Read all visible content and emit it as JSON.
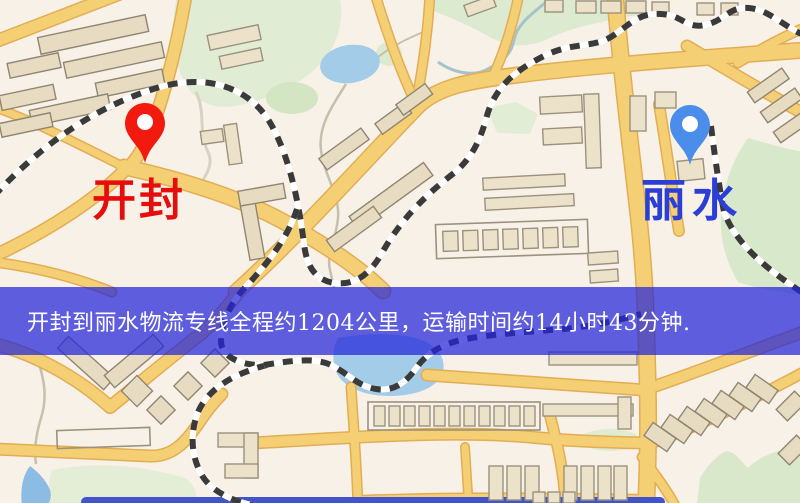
{
  "banner": {
    "text": "开封到丽水物流专线全程约1204公里，运输时间约14小时43分钟.",
    "bg_color": "#2224da",
    "opacity": "0.72",
    "text_color": "#ffffff"
  },
  "markers": {
    "origin": {
      "label": "开封",
      "label_color": "#e60d0d",
      "pin_color": "#f2190f"
    },
    "destination": {
      "label": "丽水",
      "label_color": "#2b3fd6",
      "pin_color": "#4a8dea"
    }
  }
}
